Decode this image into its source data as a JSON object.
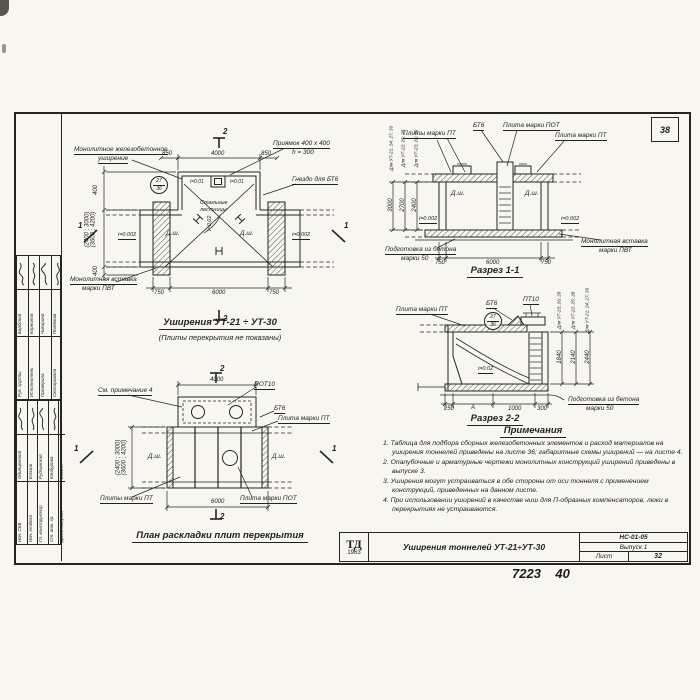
{
  "sheet": {
    "corner_number": "38",
    "handwritten": "7223    40",
    "stamp": {
      "logo_top": "ТД",
      "logo_year": "1963",
      "title": "Уширения тоннелей УТ-21÷УТ-30",
      "code": "НС-01-05",
      "issue": "Выпуск 1",
      "sheet_label": "Лист",
      "sheet_number": "32"
    }
  },
  "sidebar": {
    "upper": [
      {
        "role": "Рук. группы",
        "name": "Барбский"
      },
      {
        "role": "Исполнитель",
        "name": "Корнилов"
      },
      {
        "role": "Проверила",
        "name": "Чикирина"
      },
      {
        "role": "Скопировала",
        "name": "Полякова"
      }
    ],
    "lower": [
      {
        "role": "Нач. СКБ",
        "name": "Одинцовский"
      },
      {
        "role": "Нач. отдела",
        "name": "Елизов"
      },
      {
        "role": "Гл. конструктор",
        "name": "Рудзинский"
      },
      {
        "role": "Ст. инж. гр.",
        "name": "Кондурова"
      },
      {
        "role": "Дата выпуска",
        "name": "1963 г."
      }
    ]
  },
  "plan": {
    "title": "Уширения УТ-21 ÷ УТ-30",
    "subtitle": "(Плиты перекрытия не показаны)",
    "labels": {
      "widening_l1": "Монолитное железобетонное",
      "widening_l2": "уширение",
      "pit_l1": "Приямок 400 х 400",
      "pit_l2": "h = 300",
      "socket": "Гнездо для БТ6",
      "stairs_l1": "Стальные",
      "stairs_l2": "лестницы",
      "insert_l1": "Монолитная вставка",
      "insert_l2": "марки ПВТ",
      "dsh": "Д.ш.",
      "slope_side": "i=0.002",
      "slope_center": "i=0.02",
      "slope_pit": "i=0.01",
      "detail_top": "27",
      "detail_bottom": "36"
    },
    "dims": {
      "top_left": "850",
      "top_mid": "4000",
      "top_right": "850",
      "bot_left": "750",
      "bot_mid": "6000",
      "bot_right": "750",
      "left_top": "400",
      "left_mid1": "(2400 ; 3000)",
      "left_mid2": "(3600 ; 4200)",
      "left_bot": "400"
    },
    "sections": {
      "s1": "1",
      "s2": "2"
    }
  },
  "section11": {
    "title": "Разрез 1-1",
    "labels": {
      "plates_pt_left": "Плиты марки ПТ",
      "bt6": "БТ6",
      "plate_pot": "Плита марки ПОТ",
      "plate_pt_right": "Плита марки ПТ",
      "insert_l1": "Монолитная вставка",
      "insert_l2": "марки ПВТ",
      "prep_l1": "Подготовка из бетона",
      "prep_l2": "марки 50",
      "dsh": "Д.ш.",
      "slope": "i=0.002"
    },
    "dims": {
      "bot_left": "750",
      "bot_mid": "6000",
      "bot_right": "750"
    },
    "heights": [
      {
        "label": "Для УТ-21; 24; 27; 30",
        "value": "3000"
      },
      {
        "label": "Для УТ-22; 25; 28",
        "value": "2700"
      },
      {
        "label": "Для УТ-23; 26; 29",
        "value": "2400"
      }
    ]
  },
  "section22": {
    "title": "Разрез 2-2",
    "labels": {
      "plate_pt": "Плита марки ПТ",
      "bt6": "БТ6",
      "pt10": "ПТ10",
      "prep_l1": "Подготовка из бетона",
      "prep_l2": "марки 50",
      "slope": "i=0.02",
      "detail_top": "27",
      "detail_bottom": "36"
    },
    "dims": {
      "d1": "250",
      "d2": "А",
      "d3": "1000",
      "d4": "300"
    },
    "heights": [
      {
        "label": "Для УТ-23; 26; 29",
        "value": "1840"
      },
      {
        "label": "Для УТ-22; 25; 28",
        "value": "2140"
      },
      {
        "label": "Для УТ-21; 24; 27; 30",
        "value": "2440"
      }
    ]
  },
  "slab_plan": {
    "title": "План раскладки плит перекрытия",
    "labels": {
      "see_note": "См. примечание 4",
      "pot10": "ПОТ10",
      "bt6": "БТ6",
      "plate_pt": "Плита марки ПТ",
      "plates_pt": "Плиты марки ПТ",
      "plate_pot": "Плита марки ПОТ",
      "dsh": "Д.ш."
    },
    "dims": {
      "top": "4000",
      "bottom": "6000",
      "left_l1": "(2400 ; 3000)",
      "left_l2": "(3600 ; 4200)"
    },
    "sections": {
      "s1": "1",
      "s2": "2"
    }
  },
  "notes": {
    "title": "Примечания",
    "items": [
      {
        "num": "1.",
        "text": "Таблица для подбора сборных железобетонных элементов и расход материалов на уширения тоннелей приведены на листе 36; габаритные схемы уширений — на листе 4."
      },
      {
        "num": "2.",
        "text": "Опалубочные и арматурные чертежи монолитных конструкций уширений приведены в выпуске 3."
      },
      {
        "num": "3.",
        "text": "Уширения могут устраиваться в обе стороны от оси тоннеля с применением конструкций, приведенных на данном листе."
      },
      {
        "num": "4.",
        "text": "При использовании уширений в качестве ниш для П-образных компенсаторов, люки в перекрытиях не устраиваются."
      }
    ]
  }
}
